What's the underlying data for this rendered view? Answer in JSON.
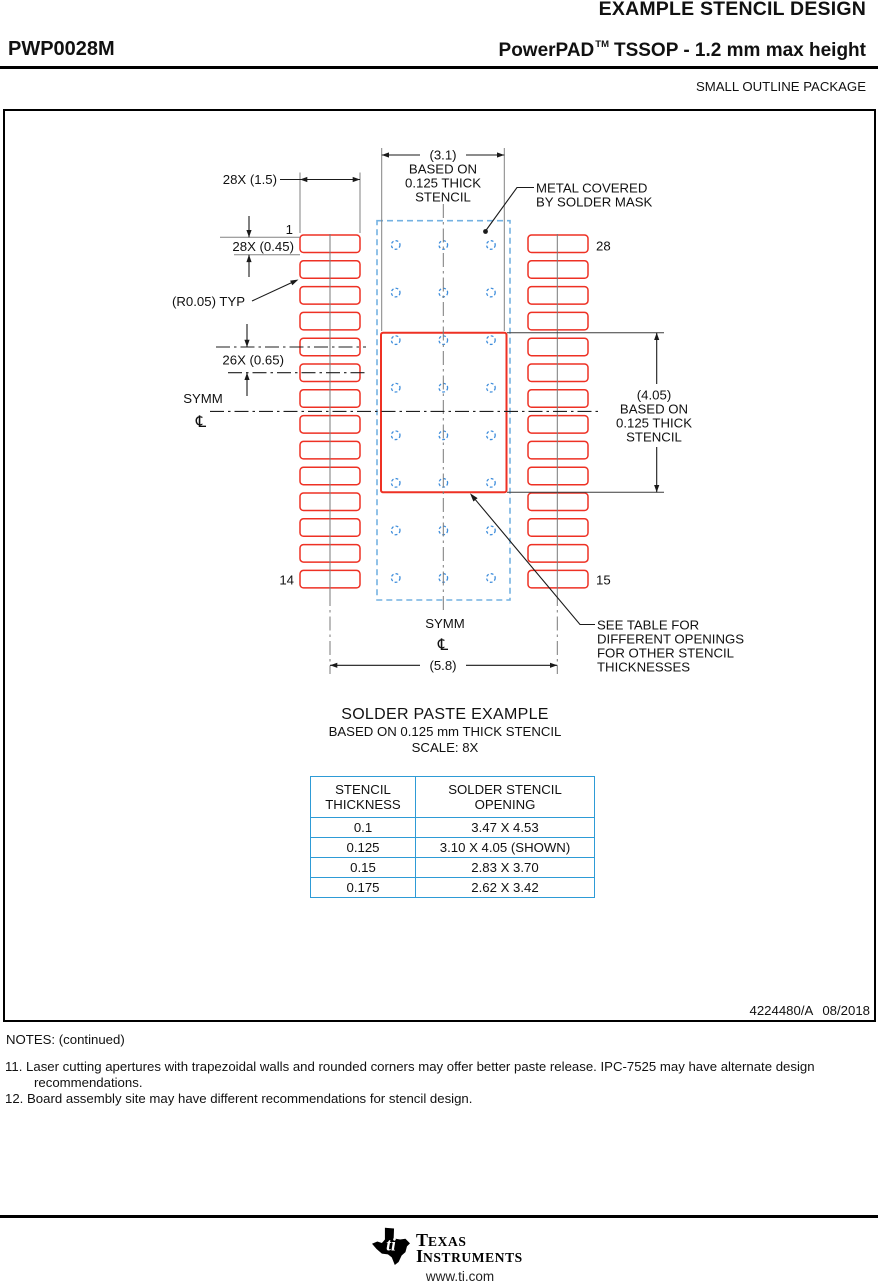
{
  "header": {
    "doc_title": "EXAMPLE STENCIL DESIGN",
    "part_number": "PWP0028M",
    "family": "PowerPAD",
    "trademark": "TM",
    "family_rest": "TSSOP - 1.2 mm max height",
    "package_type": "SMALL OUTLINE PACKAGE"
  },
  "drawing": {
    "dim_width_block": [
      "(3.1)",
      "BASED ON",
      "0.125 THICK",
      "STENCIL"
    ],
    "mask_note": [
      "METAL COVERED",
      "BY SOLDER MASK"
    ],
    "dim_pad_length": "28X (1.5)",
    "dim_pad_width": "28X (0.45)",
    "dim_pitch": "26X (0.65)",
    "radius_note": "(R0.05) TYP",
    "symm_label": "SYMM",
    "centerline_symbol": "℄",
    "dim_height_block": [
      "(4.05)",
      "BASED ON",
      "0.125 THICK",
      "STENCIL"
    ],
    "dim_span": "(5.8)",
    "see_table_note": [
      "SEE TABLE FOR",
      "DIFFERENT OPENINGS",
      "FOR OTHER STENCIL",
      "THICKNESSES"
    ],
    "pins": {
      "p1": "1",
      "p28": "28",
      "p14": "14",
      "p15": "15"
    },
    "doc_number": "4224480/A",
    "doc_date": "08/2018"
  },
  "example": {
    "title": "SOLDER PASTE EXAMPLE",
    "basis": "BASED ON 0.125 mm THICK STENCIL",
    "scale": "SCALE: 8X"
  },
  "table": {
    "headers": [
      [
        "STENCIL",
        "THICKNESS"
      ],
      [
        "SOLDER STENCIL",
        "OPENING"
      ]
    ],
    "rows": [
      [
        "0.1",
        "3.47 X 4.53"
      ],
      [
        "0.125",
        "3.10 X 4.05 (SHOWN)"
      ],
      [
        "0.15",
        "2.83 X 3.70"
      ],
      [
        "0.175",
        "2.62 X 3.42"
      ]
    ]
  },
  "notes": {
    "heading": "NOTES: (continued)",
    "items": [
      {
        "num": "11.",
        "text": "Laser cutting apertures with trapezoidal walls and rounded corners may offer better paste release. IPC-7525 may have alternate design recommendations."
      },
      {
        "num": "12.",
        "text": "Board assembly site may have different recommendations for stencil design."
      }
    ]
  },
  "footer": {
    "brand1_initial": "T",
    "brand1_rest": "EXAS",
    "brand2_initial": "I",
    "brand2_rest": "NSTRUMENTS",
    "url": "www.ti.com"
  },
  "colors": {
    "pad_red": "#ee3124",
    "mask_blue": "#74b2e2",
    "via_blue": "#3f8edc",
    "table_blue": "#2e9bd6"
  }
}
